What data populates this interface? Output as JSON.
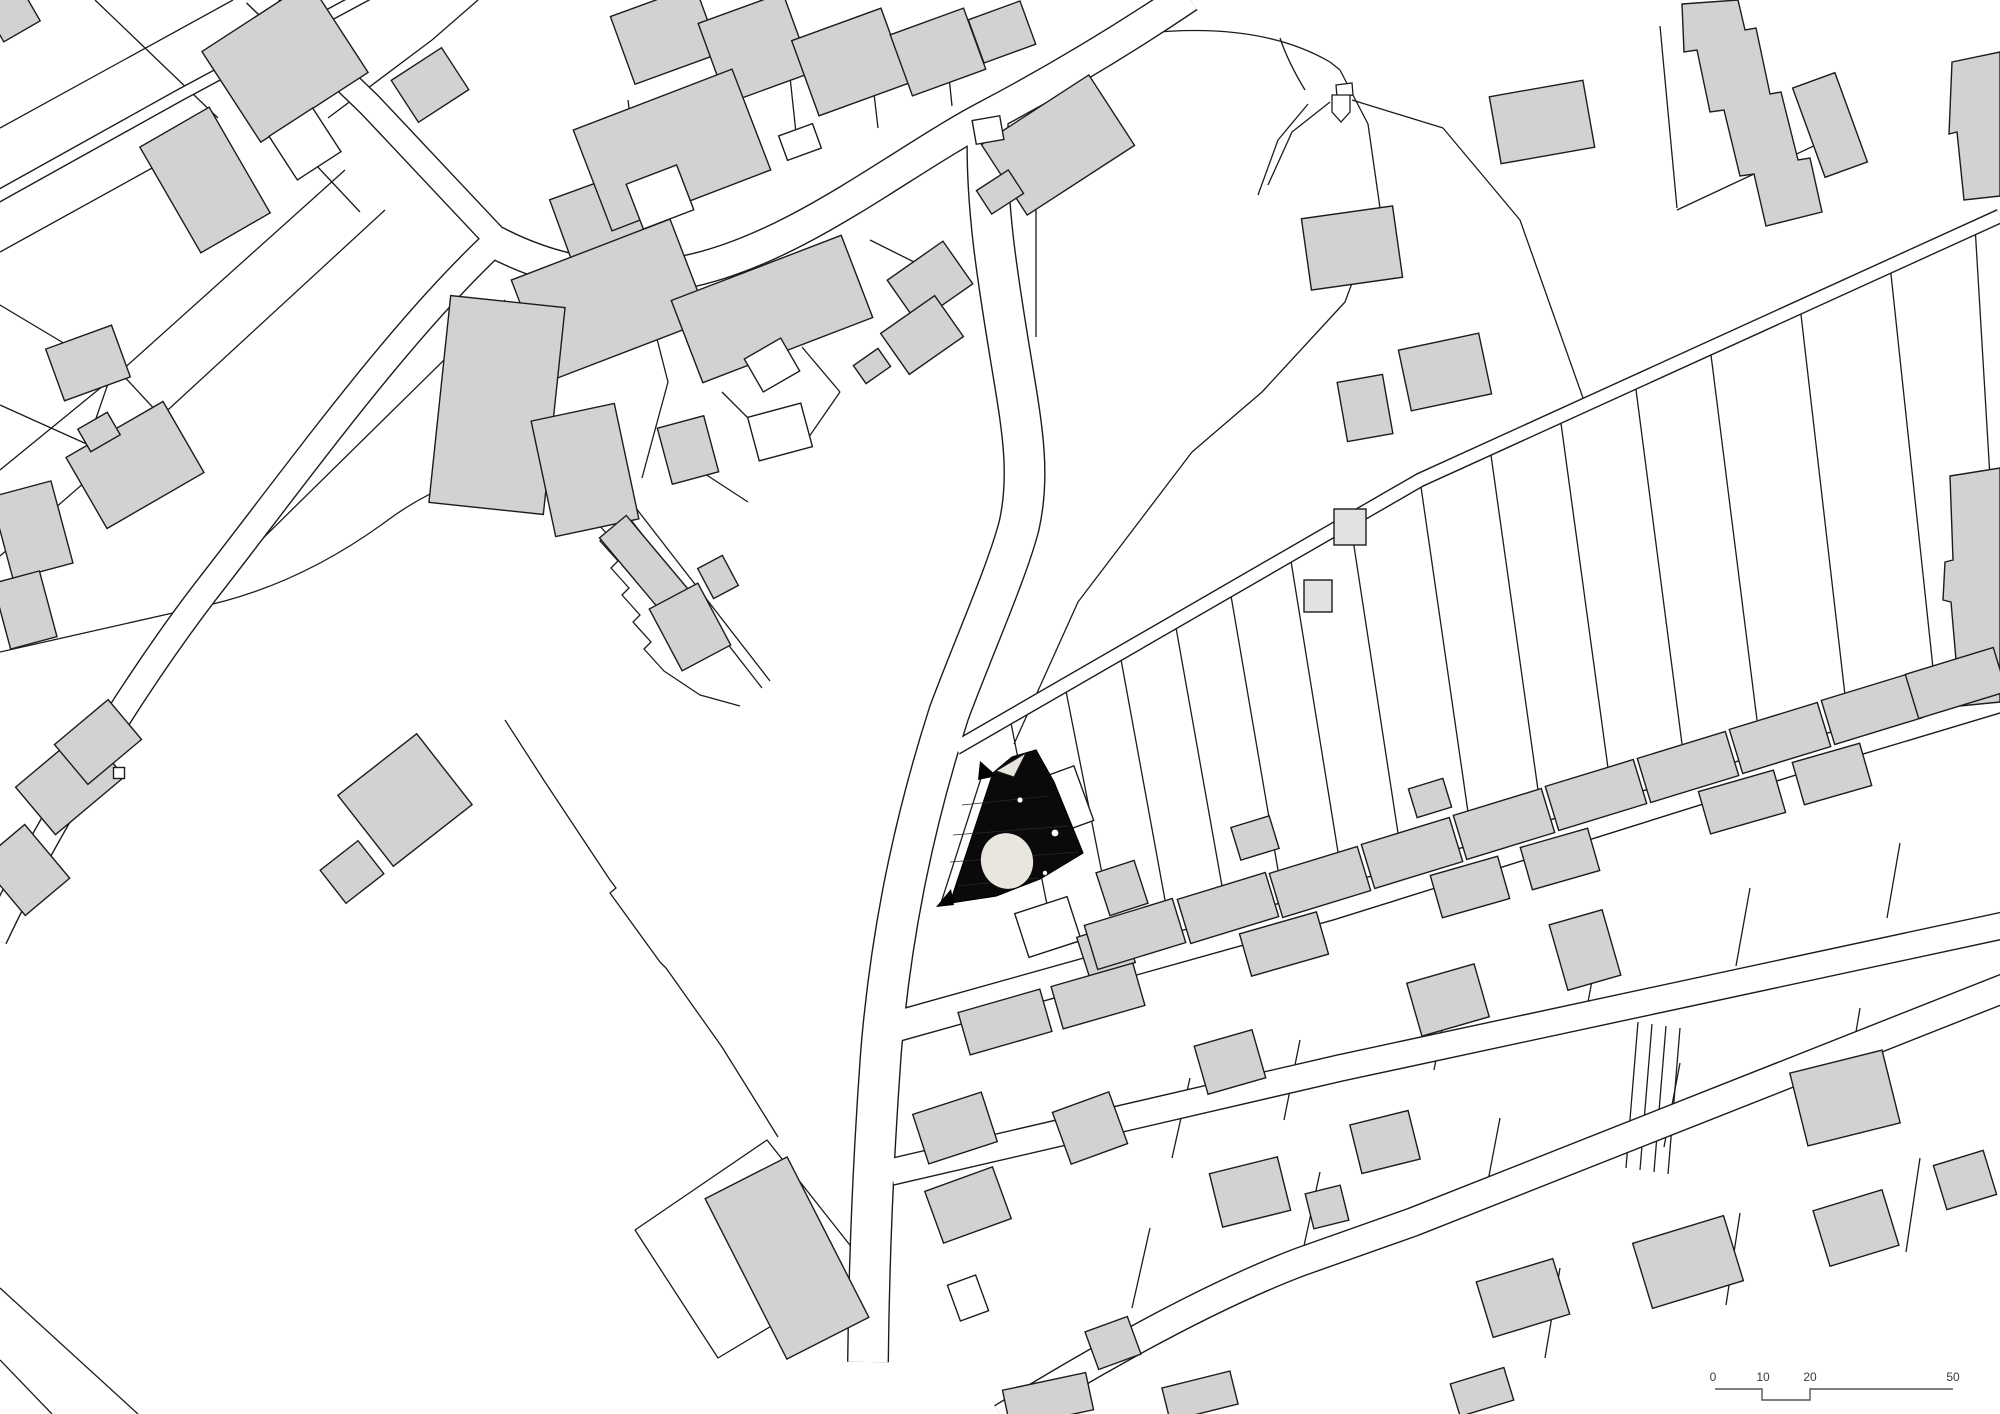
{
  "canvas": {
    "width": 2000,
    "height": 1414
  },
  "colors": {
    "background": "#ffffff",
    "line": "#1c1c1c",
    "building_gray": "#d2d2d2",
    "building_light": "#e2e2e2",
    "building_white": "#ffffff",
    "site_black": "#0a0a0a",
    "site_ellipse": "#e9e5df",
    "scale_text": "#3a3a3a"
  },
  "scale_bar": {
    "labels": [
      "0",
      "10",
      "20",
      "50"
    ],
    "label_x": [
      1713,
      1763,
      1810,
      1953
    ],
    "text_y": 1381,
    "bar_path": "M1715,1389 L1762,1389 L1762,1400 L1810,1400 L1810,1389 L1953,1389"
  },
  "flag_marker": {
    "pentagon": "M1332,95 L1350,95 L1350,112 L1341,122 L1332,112 Z",
    "cap": "M1336,85 L1352,83 L1353,95 L1337,97 Z",
    "lines": [
      "M1305,90 Q1288,62 1280,38",
      "M1352,100 L1443,128",
      "M1330,102 L1292,132 L1268,185",
      "M1308,104 L1278,140 L1258,195"
    ]
  },
  "site": {
    "outline": "M950,903 L993,773 L1012,757 L1036,750 L1054,782 L1083,853 L1040,879 L996,896 Z",
    "wedge": "M996,771 L1026,753 L1014,777 Z",
    "stripes": [
      "M962,805 L1048,796",
      "M953,835 L1068,826",
      "M950,862 L1078,852",
      "M958,886 L1038,878"
    ],
    "ellipse": {
      "cx": 1007,
      "cy": 861,
      "rx": 26,
      "ry": 28,
      "rot": -15
    },
    "dots": [
      [
        1020,
        800,
        2.6
      ],
      [
        1055,
        833,
        3.4
      ],
      [
        1045,
        873,
        2.2
      ]
    ],
    "arrows": [
      "M980,761 L997,776 L978,780 Z",
      "M936,907 L951,889 L954,905 Z"
    ]
  },
  "roads": [
    {
      "d": "M368,-6 L180,95 L-5,198",
      "w": 13
    },
    {
      "d": "M255,-6 L370,105 L497,240",
      "w": 26
    },
    {
      "d": "M497,240 C400,330 300,470 205,592 C130,690 45,830 -6,938",
      "w": 28
    },
    {
      "d": "M495,242 C560,276 625,283 685,272 C795,250 900,162 988,116 C1056,80 1120,42 1188,-4",
      "w": 34
    },
    {
      "d": "M988,118 C984,205 1000,292 1013,372 C1023,432 1030,477 1019,526 C1007,572 974,646 949,713 C914,822 891,932 881,1052 C873,1162 869,1262 868,1362",
      "w": 42
    },
    {
      "d": "M956,748 L1420,480 L2000,216",
      "w": 15
    },
    {
      "d": "M876,1032 L1330,905 L1850,742 L2010,694",
      "w": 32
    },
    {
      "d": "M891,1172 L1340,1068 L2010,924",
      "w": 28
    },
    {
      "d": "M1002,1418 C1080,1370 1200,1300 1300,1262 L1413,1222 L2010,986",
      "w": 30
    }
  ],
  "parcel_lines": [
    "M233,0 L0,128",
    "M95,0 L218,118",
    "M0,252 L163,162",
    "M345,170 L120,372 L0,470",
    "M385,210 L170,408 L0,556",
    "M120,372 L172,428",
    "M163,162 L205,206",
    "M328,118 L432,40",
    "M432,40 L478,0",
    "M300,148 L360,212",
    "M0,305 L112,372",
    "M112,372 L92,430",
    "M0,405 L140,468",
    "M592,472 Q480,452 388,520 Q296,588 195,608 L0,652",
    "M578,487 l18,20 l-7,7 l18,20 l-7,7 l18,20 l-7,7 l18,20 l-7,7 l18,20 l-7,7 l18,20 l-7,7 l20,22 L700,695 L740,706",
    "M592,470 L762,688",
    "M601,463 L770,681",
    "M640,196 L628,100",
    "M718,175 L706,80",
    "M798,152 L788,58",
    "M878,128 L868,42",
    "M952,106 L944,28",
    "M645,292 L668,382",
    "M668,382 L642,478",
    "M722,392 L762,432",
    "M702,472 L748,502",
    "M802,347 L840,392",
    "M840,392 L804,444",
    "M870,240 L916,263",
    "M505,300 L182,618",
    "M1036,337 L1036,142 Q1040,48 1138,34 Q1258,20 1330,62 L1340,70 L1368,124 L1380,208 L1345,302 L1262,392 L1192,452",
    "M1192,452 L1078,602 L1014,744",
    "M1443,128 L1520,220 L1583,398",
    "M1660,26 L1677,208",
    "M1677,210 L1850,129",
    "M940,906 L983,772",
    "M505,720 L545,782 L610,880 L616,888 L610,893 L660,962 L666,968 L722,1047 L778,1137",
    "M635,1230 L767,1140 L868,1268 L718,1358 Z",
    "M0,1288 L138,1414",
    "M0,1360 L52,1414",
    "M1010,718 L1052,930",
    "M1065,686 L1110,914",
    "M1120,654 L1165,900",
    "M1175,622 L1222,886",
    "M1230,590 L1278,870",
    "M1290,555 L1338,852",
    "M1350,520 L1398,833",
    "M1420,480 L1468,812",
    "M1490,448 L1538,790",
    "M1560,416 L1608,768",
    "M1635,382 L1682,744",
    "M1710,347 L1757,720",
    "M1800,306 L1845,695",
    "M1890,265 L1933,668",
    "M1975,226 L2000,645",
    "M1190,1078 L1172,1158",
    "M1300,1040 L1284,1120",
    "M1450,988 L1434,1070",
    "M1600,938 L1585,1018",
    "M1750,888 L1736,966",
    "M1900,843 L1887,918",
    "M1150,1228 L1132,1308",
    "M1320,1172 L1302,1255",
    "M1500,1118 L1484,1202",
    "M1680,1063 L1664,1147",
    "M1860,1008 L1846,1092",
    "M1560,1268 L1545,1358",
    "M1740,1213 L1726,1305",
    "M1920,1158 L1906,1252",
    "M1638,1022 L1626,1168",
    "M1652,1024 L1640,1170",
    "M1666,1026 L1654,1172",
    "M1680,1028 L1668,1174"
  ],
  "shapes": [
    {
      "d": "M1682,4 L1738,0 L1745,30 L1756,28 L1770,94 L1781,92 L1798,160 L1810,158 L1822,212 L1766,226 L1754,174 L1740,176 L1724,110 L1710,112 L1697,50 L1684,52 Z",
      "fill": "g"
    },
    {
      "d": "M1952,62 L2000,52 L2000,196 L1964,200 L1957,132 L1949,134 Z",
      "fill": "g"
    },
    {
      "d": "M1950,476 L2000,468 L2000,702 L1960,706 L1951,602 L1943,600 L1945,562 L1953,560 Z",
      "fill": "g"
    }
  ],
  "buildings": [
    [
      285,
      62,
      128,
      108,
      -33,
      "g"
    ],
    [
      430,
      85,
      60,
      50,
      -33,
      "g"
    ],
    [
      205,
      180,
      80,
      122,
      -30,
      "g"
    ],
    [
      305,
      144,
      52,
      52,
      -33,
      "w"
    ],
    [
      88,
      363,
      70,
      55,
      -20,
      "g"
    ],
    [
      32,
      530,
      62,
      85,
      -15,
      "g"
    ],
    [
      25,
      610,
      48,
      68,
      -15,
      "g"
    ],
    [
      135,
      465,
      112,
      82,
      -30,
      "g"
    ],
    [
      99,
      432,
      34,
      26,
      -30,
      "g"
    ],
    [
      12,
      14,
      42,
      40,
      -30,
      "g"
    ],
    [
      665,
      35,
      90,
      72,
      -20,
      "g"
    ],
    [
      755,
      48,
      90,
      85,
      -20,
      "g"
    ],
    [
      850,
      62,
      95,
      80,
      -20,
      "g"
    ],
    [
      938,
      52,
      78,
      65,
      -20,
      "g"
    ],
    [
      1002,
      32,
      55,
      46,
      -20,
      "g"
    ],
    [
      720,
      132,
      40,
      30,
      -20,
      "w"
    ],
    [
      800,
      142,
      36,
      26,
      -20,
      "w"
    ],
    [
      612,
      225,
      100,
      90,
      -20,
      "g"
    ],
    [
      672,
      150,
      170,
      108,
      -21,
      "g"
    ],
    [
      660,
      197,
      54,
      48,
      -21,
      "w"
    ],
    [
      610,
      300,
      170,
      108,
      -21,
      "g"
    ],
    [
      772,
      309,
      182,
      88,
      -21,
      "g"
    ],
    [
      930,
      282,
      68,
      52,
      -35,
      "g"
    ],
    [
      922,
      335,
      66,
      50,
      -35,
      "g"
    ],
    [
      872,
      366,
      30,
      22,
      -35,
      "g"
    ],
    [
      497,
      405,
      115,
      208,
      6,
      "g"
    ],
    [
      585,
      470,
      85,
      118,
      -12,
      "g"
    ],
    [
      688,
      450,
      48,
      58,
      -15,
      "g"
    ],
    [
      645,
      565,
      35,
      100,
      -40,
      "g"
    ],
    [
      690,
      627,
      55,
      70,
      -28,
      "g"
    ],
    [
      718,
      577,
      28,
      34,
      -28,
      "g"
    ],
    [
      772,
      365,
      42,
      38,
      -30,
      "w"
    ],
    [
      780,
      432,
      55,
      45,
      -15,
      "w"
    ],
    [
      1058,
      145,
      128,
      84,
      -33,
      "g"
    ],
    [
      1000,
      192,
      38,
      28,
      -33,
      "g"
    ],
    [
      988,
      130,
      28,
      24,
      -10,
      "w"
    ],
    [
      1542,
      122,
      95,
      68,
      -10,
      "g"
    ],
    [
      1352,
      248,
      92,
      72,
      -8,
      "g"
    ],
    [
      1445,
      372,
      82,
      62,
      -12,
      "g"
    ],
    [
      1365,
      408,
      46,
      60,
      -10,
      "g"
    ],
    [
      1350,
      527,
      32,
      36,
      0,
      "l"
    ],
    [
      1318,
      596,
      28,
      32,
      0,
      "l"
    ],
    [
      1830,
      125,
      45,
      95,
      -20,
      "g"
    ],
    [
      405,
      800,
      100,
      90,
      -38,
      "g"
    ],
    [
      352,
      872,
      48,
      42,
      -38,
      "g"
    ],
    [
      70,
      782,
      90,
      62,
      -40,
      "g"
    ],
    [
      98,
      742,
      70,
      52,
      -40,
      "g"
    ],
    [
      25,
      870,
      58,
      70,
      -40,
      "g"
    ],
    [
      119,
      773,
      11,
      11,
      0,
      "w"
    ],
    [
      1065,
      800,
      40,
      58,
      -20,
      "w"
    ],
    [
      1048,
      927,
      55,
      46,
      -18,
      "w"
    ],
    [
      1122,
      888,
      40,
      45,
      -18,
      "g"
    ],
    [
      1106,
      950,
      48,
      42,
      -18,
      "g"
    ],
    [
      1135,
      934,
      92,
      46,
      -17,
      "g"
    ],
    [
      1228,
      908,
      92,
      46,
      -17,
      "g"
    ],
    [
      1320,
      882,
      92,
      46,
      -17,
      "g"
    ],
    [
      1412,
      853,
      92,
      46,
      -17,
      "g"
    ],
    [
      1504,
      824,
      92,
      46,
      -17,
      "g"
    ],
    [
      1596,
      795,
      92,
      46,
      -17,
      "g"
    ],
    [
      1688,
      767,
      92,
      46,
      -17,
      "g"
    ],
    [
      1780,
      738,
      92,
      46,
      -17,
      "g"
    ],
    [
      1872,
      709,
      92,
      46,
      -17,
      "g"
    ],
    [
      1956,
      683,
      92,
      46,
      -17,
      "g"
    ],
    [
      1255,
      838,
      40,
      34,
      -17,
      "g"
    ],
    [
      1430,
      798,
      36,
      30,
      -17,
      "g"
    ],
    [
      1005,
      1022,
      85,
      44,
      -16,
      "g"
    ],
    [
      1098,
      996,
      85,
      44,
      -16,
      "g"
    ],
    [
      1284,
      944,
      80,
      44,
      -16,
      "g"
    ],
    [
      1470,
      887,
      70,
      44,
      -16,
      "g"
    ],
    [
      1560,
      859,
      70,
      44,
      -16,
      "g"
    ],
    [
      1742,
      802,
      78,
      44,
      -16,
      "g"
    ],
    [
      1832,
      774,
      70,
      44,
      -16,
      "g"
    ],
    [
      955,
      1128,
      72,
      52,
      -18,
      "g"
    ],
    [
      1090,
      1128,
      60,
      55,
      -20,
      "g"
    ],
    [
      1448,
      1000,
      70,
      55,
      -16,
      "g"
    ],
    [
      1585,
      950,
      55,
      68,
      -16,
      "g"
    ],
    [
      1230,
      1062,
      60,
      50,
      -16,
      "g"
    ],
    [
      968,
      1205,
      72,
      55,
      -20,
      "g"
    ],
    [
      968,
      1298,
      30,
      38,
      -20,
      "w"
    ],
    [
      1845,
      1098,
      95,
      75,
      -14,
      "g"
    ],
    [
      1250,
      1192,
      70,
      55,
      -14,
      "g"
    ],
    [
      1385,
      1142,
      60,
      50,
      -14,
      "g"
    ],
    [
      1327,
      1207,
      36,
      36,
      -14,
      "g"
    ],
    [
      1113,
      1343,
      45,
      40,
      -20,
      "g"
    ],
    [
      1048,
      1400,
      85,
      38,
      -12,
      "g"
    ],
    [
      1523,
      1298,
      80,
      58,
      -17,
      "g"
    ],
    [
      1688,
      1262,
      95,
      68,
      -17,
      "g"
    ],
    [
      1856,
      1228,
      72,
      58,
      -17,
      "g"
    ],
    [
      1482,
      1392,
      56,
      34,
      -17,
      "g"
    ],
    [
      1200,
      1396,
      70,
      34,
      -14,
      "g"
    ],
    [
      1965,
      1180,
      52,
      46,
      -17,
      "g"
    ],
    [
      787,
      1258,
      92,
      180,
      -27,
      "g"
    ]
  ]
}
